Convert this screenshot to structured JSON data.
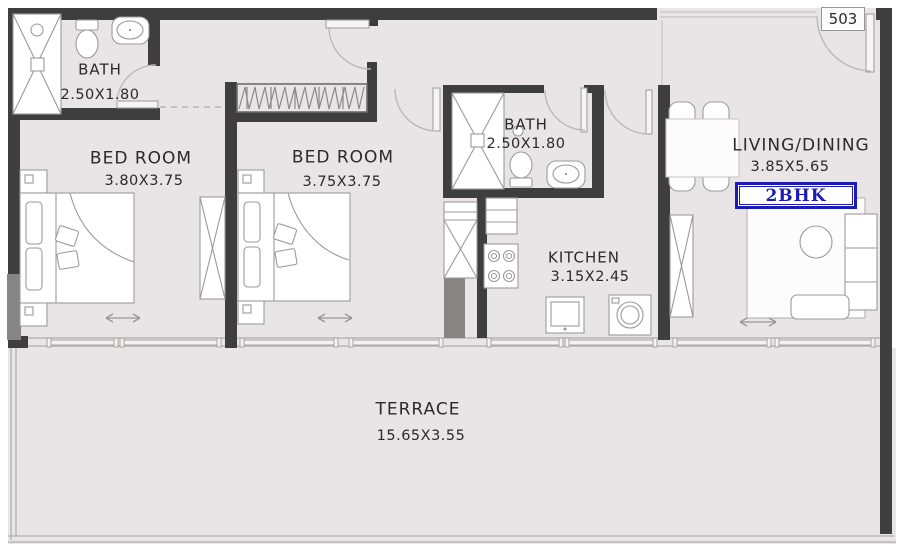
{
  "unit": {
    "number": "503",
    "type_label": "2BHK"
  },
  "rooms": {
    "bath1": {
      "name": "BATH",
      "dims": "2.50X1.80"
    },
    "bedroom1": {
      "name": "BED ROOM",
      "dims": "3.80X3.75"
    },
    "bedroom2": {
      "name": "BED ROOM",
      "dims": "3.75X3.75"
    },
    "bath2": {
      "name": "BATH",
      "dims": "2.50X1.80"
    },
    "kitchen": {
      "name": "KITCHEN",
      "dims": "3.15X2.45"
    },
    "living": {
      "name": "LIVING/DINING",
      "dims": "3.85X5.65"
    },
    "terrace": {
      "name": "TERRACE",
      "dims": "15.65X3.55"
    }
  },
  "colors": {
    "wall": "#3f3e3e",
    "floor": "#e9e5e6",
    "accent": "#1c1cb5",
    "stroke": "#9a9a9a"
  }
}
